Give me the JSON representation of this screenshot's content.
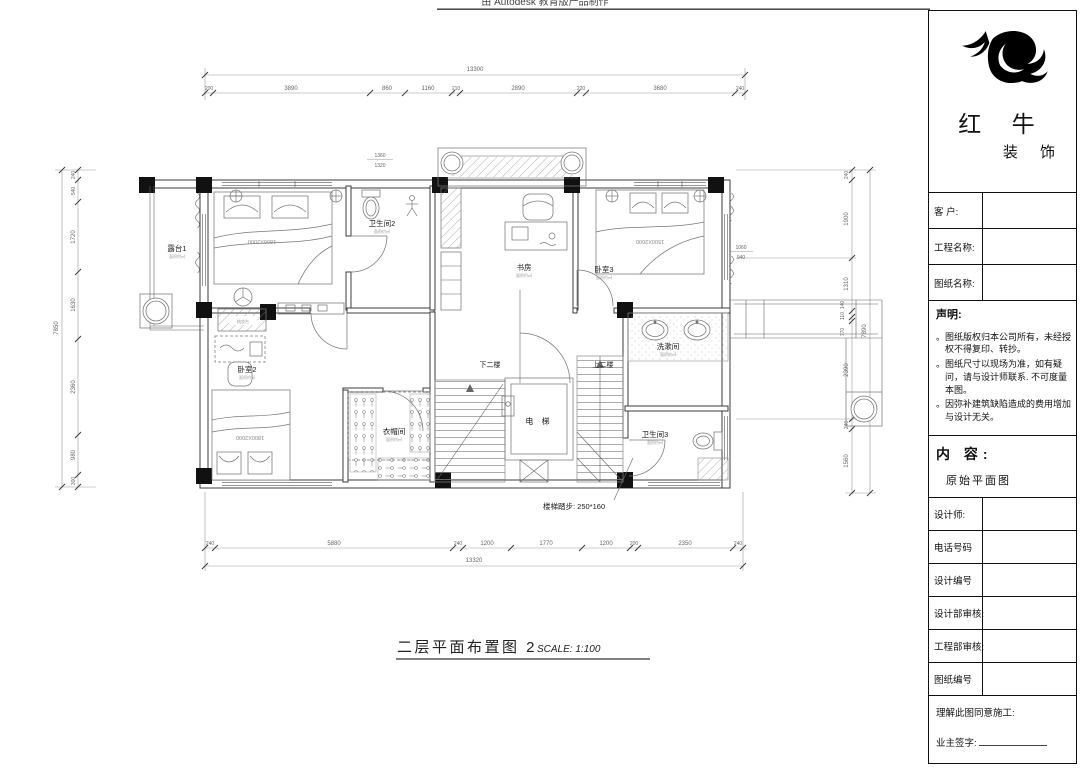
{
  "watermark": "由 Autodesk 教育版产品制作",
  "plan": {
    "title": "二层平面布置图 2",
    "scale_label": "SCALE: 1:100",
    "stair_note": "楼梯踏步: 250*160",
    "labels": {
      "terrace": "露台1",
      "bath2": "卫生间2",
      "study": "书房",
      "bed3": "卧室3",
      "wash": "洗漱间",
      "bath3": "卫生间3",
      "bed2": "卧室2",
      "cloak": "衣帽间",
      "elevator": "电 梯",
      "down": "下二楼",
      "up": "上二楼",
      "dresser": "梳妆台",
      "area_note": "面积约㎡",
      "bed1_size": "1800X2000",
      "bed2_size": "1800X2000",
      "bed3_size": "1500X2000"
    },
    "dims": {
      "top": {
        "overall": "13300",
        "segments": [
          "200",
          "3890",
          "860",
          "1160",
          "210",
          "2890",
          "220",
          "3680",
          "240"
        ]
      },
      "bottom": {
        "overall": "13320",
        "segments": [
          "240",
          "5880",
          "240",
          "1200",
          "1770",
          "1200",
          "200",
          "2350",
          "240"
        ]
      },
      "left": {
        "overall": "7850",
        "segments": [
          "240",
          "540",
          "1720",
          "1630",
          "2360",
          "980",
          "300"
        ]
      },
      "right": {
        "overall": "7890",
        "segments": [
          "240",
          "1900",
          "1310",
          "140",
          "110",
          "770",
          "2390",
          "240",
          "1560"
        ]
      },
      "stack_top": [
        "1360",
        "1320"
      ],
      "stack_right": [
        "1060",
        "940"
      ]
    }
  },
  "title_block": {
    "brand": {
      "name_l1": "红 牛",
      "name_l2": "装 饰"
    },
    "fields": {
      "client": "客  户:",
      "project": "工程名称:",
      "drawing": "图纸名称:"
    },
    "statement": {
      "heading": "声明:",
      "bullet": "。",
      "items": [
        "图纸版权归本公司所有，未经授权不得复印、转抄。",
        "图纸尺寸以现场为准，如有疑问，请与设计师联系. 不可度量本图。",
        "因弥补建筑缺陷造成的费用增加与设计无关。"
      ]
    },
    "content": {
      "heading": "内 容:",
      "value": "原始平面图"
    },
    "rows": {
      "designer": "设计师:",
      "phone": "电话号码",
      "design_no": "设计编号",
      "design_review": "设计部审核:",
      "eng_review": "工程部审核:",
      "drawing_no": "图纸编号"
    },
    "footer": {
      "agree": "理解此图同意施工:",
      "sign": "业主签字:"
    }
  }
}
